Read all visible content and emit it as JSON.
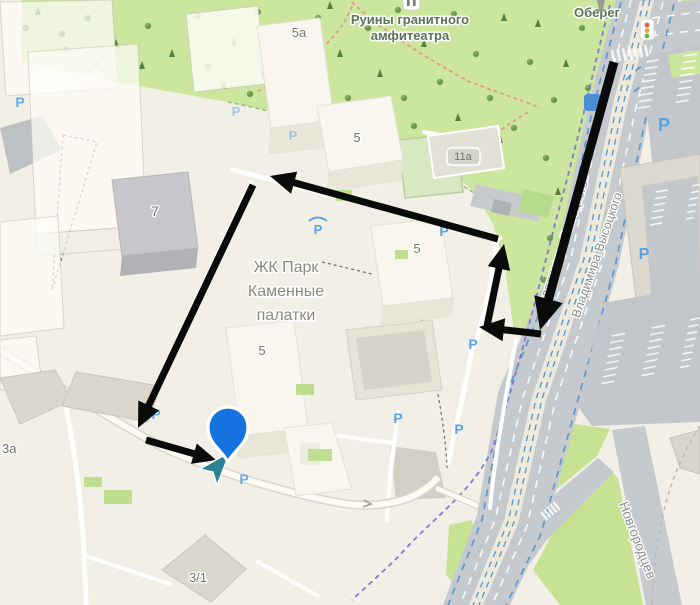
{
  "app": {
    "name": "map-view"
  },
  "labels": {
    "park_poi_line1": "Руины гранитного",
    "park_poi_line2": "амфитеатра",
    "obereg_poi": "Оберег",
    "complex_line1": "ЖК Парк",
    "complex_line2": "Каменные",
    "complex_line3": "палатки",
    "street_vysotskogo_1": "Владимира Высоцкого",
    "street_vysotskogo_2": "Владимира Высоцкого",
    "street_novgorodtsev": "Новгородцев",
    "building_5a": "5а",
    "building_5_north": "5",
    "building_5_east": "5",
    "building_5_south": "5",
    "building_7": "7",
    "building_11a": "11а",
    "building_3a": "3а",
    "building_3_1": "3/1"
  },
  "parking": {
    "label": "P",
    "color": "#57a3e8",
    "spots": [
      {
        "x": 20,
        "y": 107,
        "s": 14,
        "o": 0.9,
        "covered": false
      },
      {
        "x": 236,
        "y": 116,
        "s": 13,
        "o": 0.5,
        "covered": false
      },
      {
        "x": 293,
        "y": 140,
        "s": 13,
        "o": 0.5,
        "covered": false
      },
      {
        "x": 318,
        "y": 234,
        "s": 13,
        "o": 1,
        "covered": true
      },
      {
        "x": 444,
        "y": 236,
        "s": 14,
        "o": 1,
        "covered": false
      },
      {
        "x": 473,
        "y": 349,
        "s": 14,
        "o": 1,
        "covered": false
      },
      {
        "x": 398,
        "y": 423,
        "s": 14,
        "o": 1,
        "covered": false
      },
      {
        "x": 459,
        "y": 434,
        "s": 14,
        "o": 1,
        "covered": false
      },
      {
        "x": 664,
        "y": 131,
        "s": 18,
        "o": 1,
        "covered": false
      },
      {
        "x": 644,
        "y": 259,
        "s": 16,
        "o": 1,
        "covered": false
      },
      {
        "x": 156,
        "y": 419,
        "s": 14,
        "o": 0.9,
        "covered": false
      },
      {
        "x": 244,
        "y": 484,
        "s": 14,
        "o": 0.9,
        "covered": false
      }
    ]
  },
  "route": {
    "color": "#0a0a0a",
    "segments": [
      {
        "x1": 614,
        "y1": 62,
        "x2": 540,
        "y2": 330,
        "w": 9,
        "head": 32
      },
      {
        "x1": 541,
        "y1": 334,
        "x2": 479,
        "y2": 327,
        "w": 7,
        "head": 25
      },
      {
        "x1": 487,
        "y1": 326,
        "x2": 504,
        "y2": 244,
        "w": 7,
        "head": 25
      },
      {
        "x1": 498,
        "y1": 239,
        "x2": 270,
        "y2": 176,
        "w": 7,
        "head": 25
      },
      {
        "x1": 253,
        "y1": 185,
        "x2": 138,
        "y2": 428,
        "w": 7,
        "head": 25
      },
      {
        "x1": 146,
        "y1": 440,
        "x2": 216,
        "y2": 460,
        "w": 7,
        "head": 23
      }
    ]
  },
  "pin": {
    "x": 228,
    "y": 427,
    "color": "#1573e0",
    "outline": "#ffffff"
  },
  "entrance_arrow": {
    "color": "#2b8293"
  },
  "traffic_light": {
    "red": "#e15b52",
    "yellow": "#e8a13c",
    "green": "#6cb44d"
  },
  "colors": {
    "park_green": "#cde69e",
    "road_gray": "#c6c9cd",
    "median_beige": "#eee9da",
    "bike_lane_blue": "#4f97d4",
    "tram_purple": "#8379d8",
    "building_white": "#f8f6ef"
  }
}
